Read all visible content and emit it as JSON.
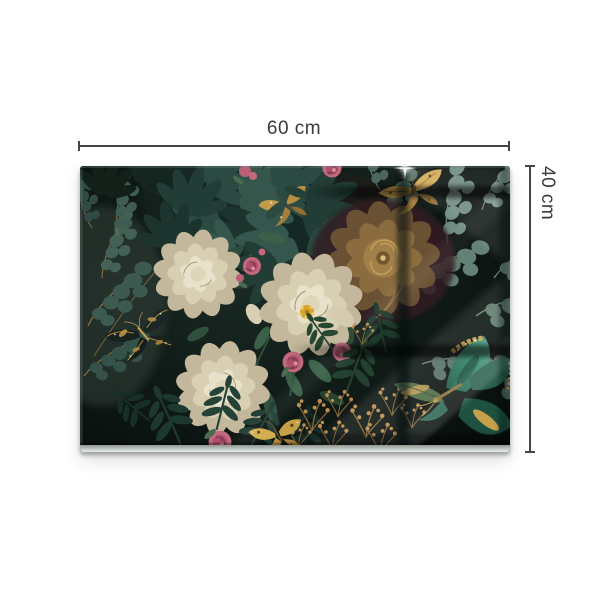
{
  "page": {
    "background": "#ffffff"
  },
  "dimensions": {
    "width_label": "60 cm",
    "height_label": "40 cm",
    "line_color": "#454545",
    "text_color": "#3a3a3a"
  },
  "artwork": {
    "name": "glass-wall-art-print",
    "subject": "Dark vintage bouquet: cream peonies, gold peony, pink roses, teal eucalyptus foliage, gold and emerald butterflies under glossy glass with window reflections",
    "colors": {
      "panel_background": "#0f1915",
      "teal_foliage": "#2b4a42",
      "sage_foliage": "#6b877b",
      "cream_petal": "#d9cfb3",
      "gold_accent": "#c9a14c",
      "pink_rose": "#c4687e",
      "emerald_butterfly": "#26604d",
      "glass_edge_highlight": "#eaeeea"
    }
  }
}
